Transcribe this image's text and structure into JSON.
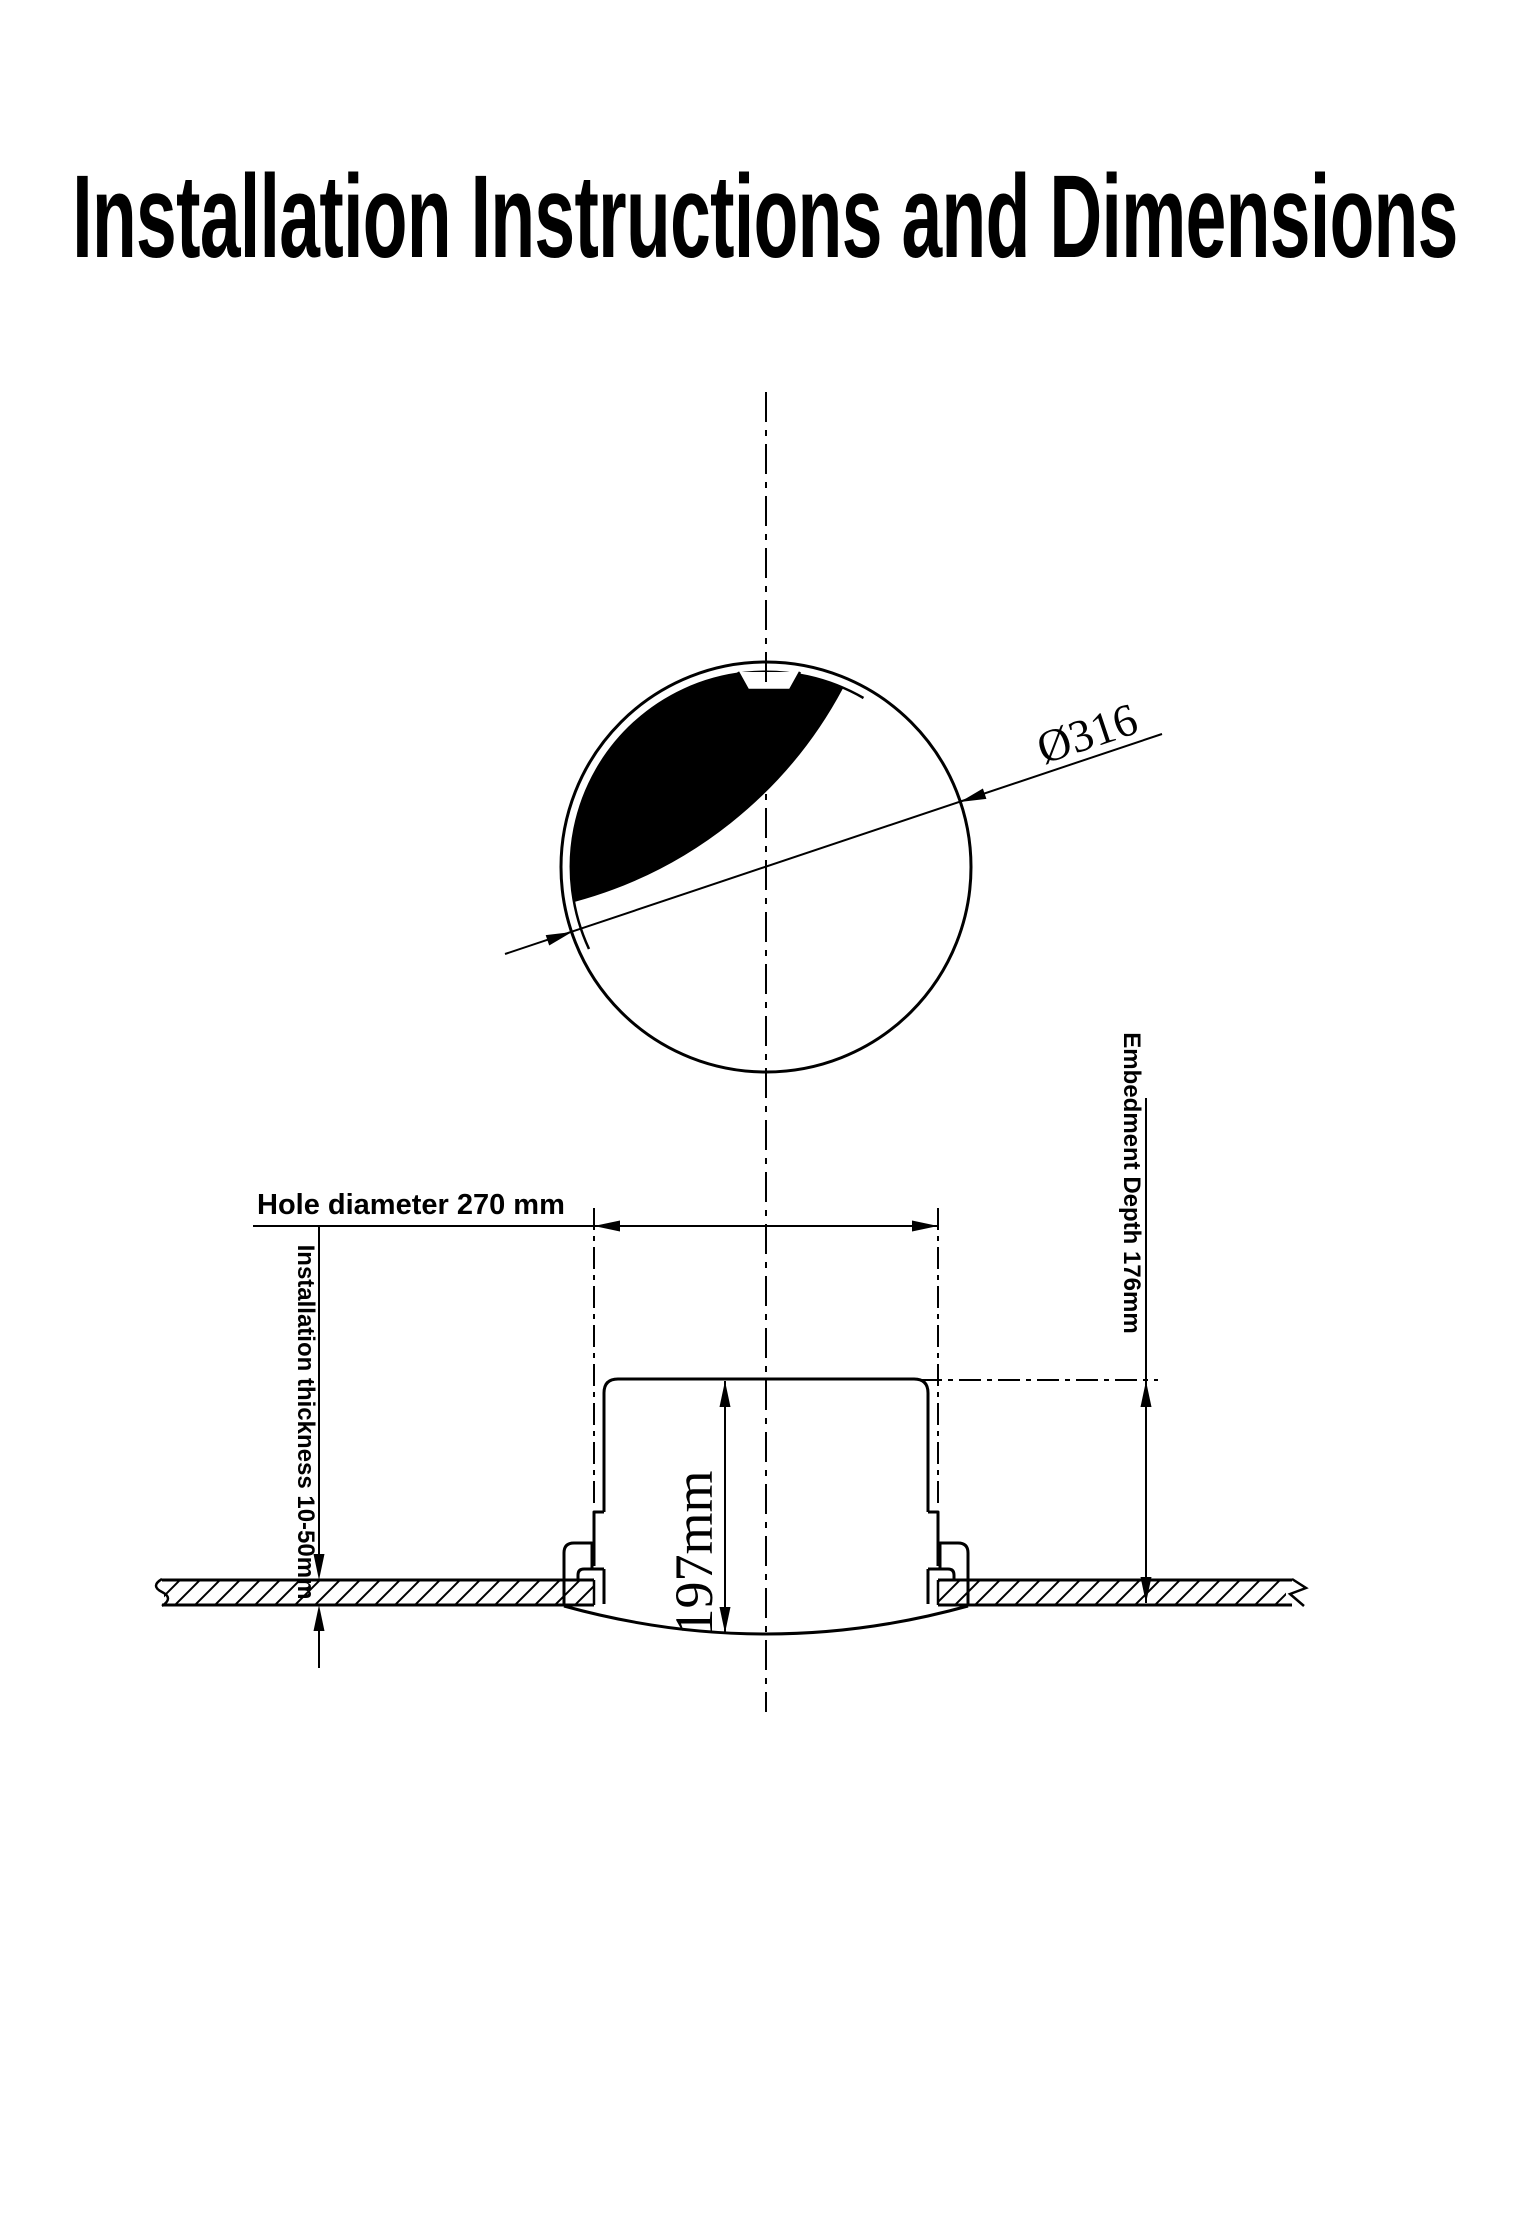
{
  "title": "Installation Instructions and Dimensions",
  "colors": {
    "ink": "#000000",
    "paper": "#ffffff"
  },
  "top_view": {
    "description": "front/top view of round speaker grille",
    "diameter_label": "Ø316"
  },
  "side_view": {
    "description": "sectional side view of speaker mounted in ceiling panel",
    "hole_diameter_label": "Hole diameter 270 mm",
    "installation_thickness_label": "Installation thickness 10-50mm",
    "embedment_depth_label": "Embedment Depth 176mm",
    "body_height_label": "197mm"
  }
}
